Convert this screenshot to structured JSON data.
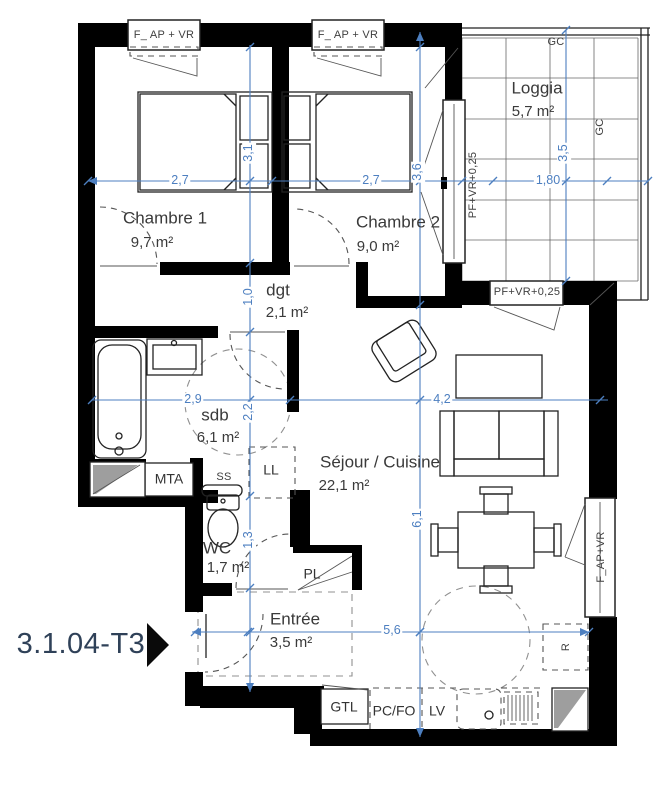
{
  "unit": {
    "label": "3.1.04-T3"
  },
  "rooms": {
    "chambre1": {
      "name": "Chambre 1",
      "area": "9,7 m²"
    },
    "chambre2": {
      "name": "Chambre 2",
      "area": "9,0 m²"
    },
    "loggia": {
      "name": "Loggia",
      "area": "5,7 m²"
    },
    "dgt": {
      "name": "dgt",
      "area": "2,1 m²"
    },
    "sdb": {
      "name": "sdb",
      "area": "6,1 m²"
    },
    "wc": {
      "name": "WC",
      "area": "1,7 m²"
    },
    "entree": {
      "name": "Entrée",
      "area": "3,5 m²"
    },
    "sejour": {
      "name": "Séjour / Cuisine",
      "area": "22,1 m²"
    }
  },
  "windows": {
    "chambre1_top": "F_ AP + VR",
    "chambre2_top": "F_ AP + VR",
    "chambre2_loggia": "PF+VR+0,25",
    "sejour_loggia": "PF+VR+0,25",
    "sejour_right": "F_AP+VR"
  },
  "equipment": {
    "mta": "MTA",
    "ss": "SS",
    "ll": "LL",
    "pl": "PL",
    "gtl": "GTL",
    "pcfo": "PC/FO",
    "lv": "LV",
    "r": "R",
    "gc_top": "GC",
    "gc_right": "GC"
  },
  "dimensions": {
    "chambre1_width": "2,7",
    "chambre1_height": "3,1",
    "chambre2_width": "2,7",
    "chambre2_height": "3,6",
    "loggia_width": "1,80",
    "loggia_height": "3,5",
    "sdb_width": "2,9",
    "sdb_height": "2,2",
    "dgt_height": "1,0",
    "wc_height": "1,3",
    "sejour_width": "4,2",
    "sejour_height": "6,1",
    "bottom_width": "5,6"
  },
  "colors": {
    "wall": "#000000",
    "dimension_blue": "#4d7fc0",
    "unit_label": "#2f4158"
  }
}
